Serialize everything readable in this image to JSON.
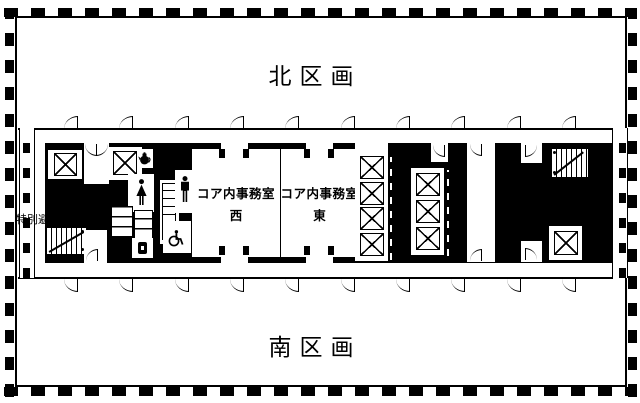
{
  "labels": {
    "north_section": "北区画",
    "south_section": "南区画",
    "core_office_west_line1": "コア内事務室",
    "core_office_west_line2": "西",
    "core_office_east_line1": "コア内事務室",
    "core_office_east_line2": "東",
    "escape_stair_left": "特別避難階段",
    "escape_stair_right": "特別避難階段"
  },
  "icons": {
    "elevator": "elevator-x-box-icon",
    "stairs": "hatched-stair-icon",
    "male_toilet": "male-figure-icon",
    "female_toilet": "female-figure-icon",
    "accessible_toilet": "wheelchair-icon",
    "kitchenette": "teapot-icon",
    "door_swing": "door-arc-icon"
  },
  "colors": {
    "wall": "#000000",
    "floor": "#ffffff"
  }
}
